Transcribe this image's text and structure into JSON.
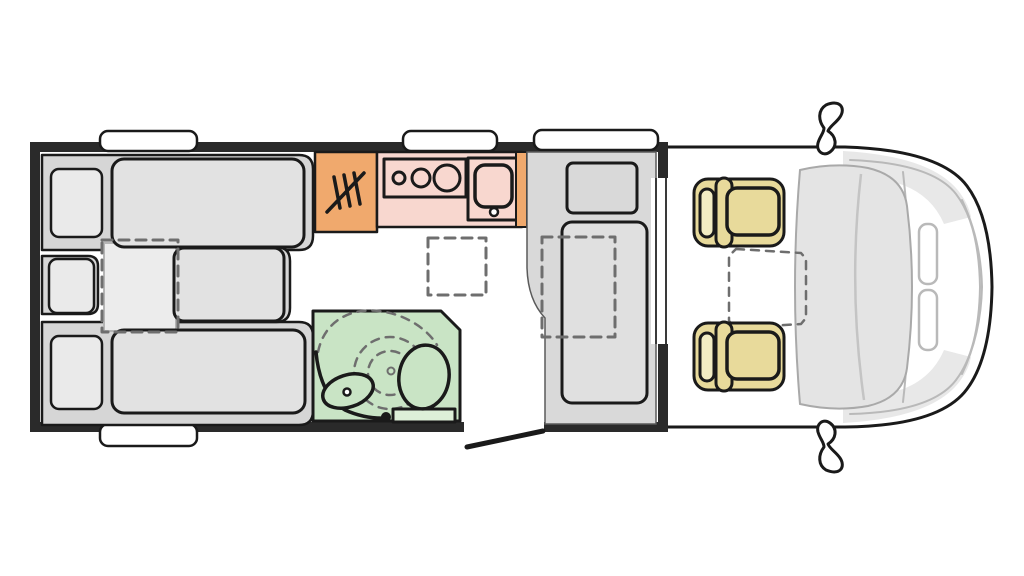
{
  "diagram": {
    "type": "motorhome-floor-plan-top-view",
    "rooms": [
      {
        "name": "rear-bedroom",
        "contents": [
          "twin-single-beds",
          "center-extension-cushion",
          "three-pillows"
        ]
      },
      {
        "name": "wardrobe",
        "contents": [
          "hanger-rail-icon"
        ]
      },
      {
        "name": "kitchen",
        "contents": [
          "three-burner-hob",
          "sink-with-drain"
        ]
      },
      {
        "name": "bathroom",
        "contents": [
          "washbasin-with-tap",
          "toilet",
          "shower-swing-dashed-arcs"
        ]
      },
      {
        "name": "dinette",
        "contents": [
          "bench-seat",
          "table",
          "bed-conversion-dashed"
        ]
      },
      {
        "name": "cab",
        "contents": [
          "driver-seat",
          "passenger-seat",
          "swivel-table-dashed",
          "windshield",
          "two-side-mirrors",
          "two-headlights"
        ]
      }
    ],
    "openings": [
      "entry-door-open-bottom",
      "cab-walkthrough-right"
    ],
    "roof_windows_count": 4,
    "counts": {
      "beds": 2,
      "pillows": 3,
      "hob_burners": 3,
      "cab_seats": 2,
      "mirrors": 2
    }
  },
  "colors": {
    "white": "#ffffff",
    "wall": "#2a2a2a",
    "outline": "#1a1a1a",
    "gray-platform": "#d6d6d6",
    "gray-mattress": "#e2e2e2",
    "gray-pad": "#ececec",
    "gray-pillow": "#eaeaea",
    "gray-dinette": "#d9d9d9",
    "gray-table": "#e0e0e0",
    "gray-patch": "#e8e8e8",
    "gray-soft": "#a9a9a9",
    "orange": "#f0a96d",
    "pink": "#f8d7cf",
    "green": "#c9e4c5",
    "green-light": "#ddefd8",
    "tan": "#e8da9b",
    "tan-light": "#f2ecc3",
    "dash": "#6e6e6e",
    "cab-line": "#b9b9b9",
    "windshield": "#e4e4e4"
  }
}
